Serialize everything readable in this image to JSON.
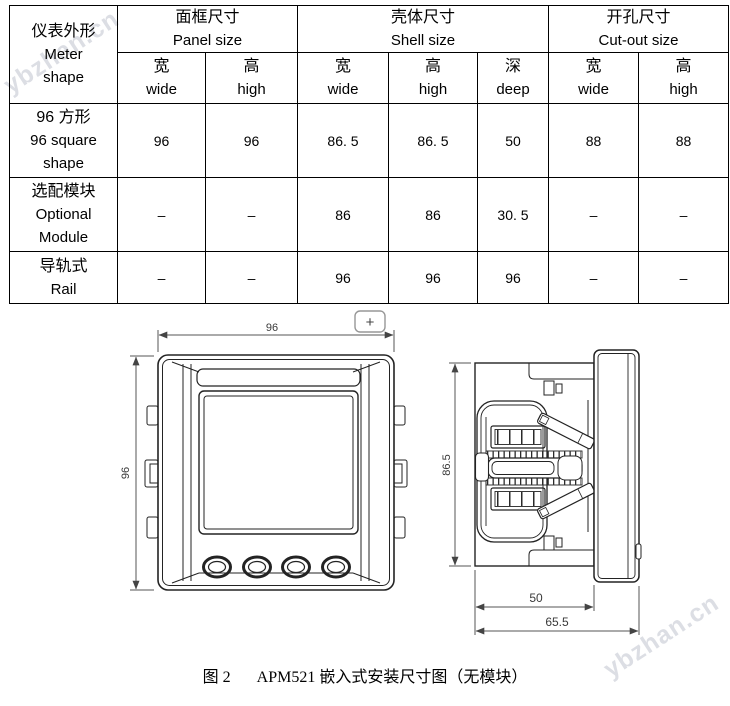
{
  "page": {
    "watermark": "ybzhan.cn",
    "caption": {
      "fig": "图 2",
      "text": "APM521 嵌入式安装尺寸图（无模块）"
    }
  },
  "table": {
    "corner": {
      "zh": "仪表外形",
      "en_lines": [
        "Meter",
        "shape"
      ]
    },
    "groups": [
      {
        "zh": "面框尺寸",
        "en": "Panel size",
        "cols": [
          {
            "zh": "宽",
            "en": "wide"
          },
          {
            "zh": "高",
            "en": "high"
          }
        ]
      },
      {
        "zh": "壳体尺寸",
        "en": "Shell size",
        "cols": [
          {
            "zh": "宽",
            "en": "wide"
          },
          {
            "zh": "高",
            "en": "high"
          },
          {
            "zh": "深",
            "en": "deep"
          }
        ]
      },
      {
        "zh": "开孔尺寸",
        "en": "Cut-out size",
        "cols": [
          {
            "zh": "宽",
            "en": "wide"
          },
          {
            "zh": "高",
            "en": "high"
          }
        ]
      }
    ],
    "rows": [
      {
        "label_lines": [
          "96 方形",
          "96 square",
          "shape"
        ],
        "values": [
          "96",
          "96",
          "86. 5",
          "86. 5",
          "50",
          "88",
          "88"
        ]
      },
      {
        "label_lines": [
          "选配模块",
          "Optional",
          "Module"
        ],
        "values": [
          "–",
          "–",
          "86",
          "86",
          "30. 5",
          "–",
          "–"
        ]
      },
      {
        "label_lines": [
          "导轨式",
          "Rail"
        ],
        "values": [
          "–",
          "–",
          "96",
          "96",
          "96",
          "–",
          "–"
        ]
      }
    ]
  },
  "drawing": {
    "plus_symbol": "+",
    "front": {
      "width_label": "96",
      "height_label": "96"
    },
    "side": {
      "height_label": "86.5",
      "depth_label": "50",
      "total_depth_label": "65.5"
    }
  }
}
